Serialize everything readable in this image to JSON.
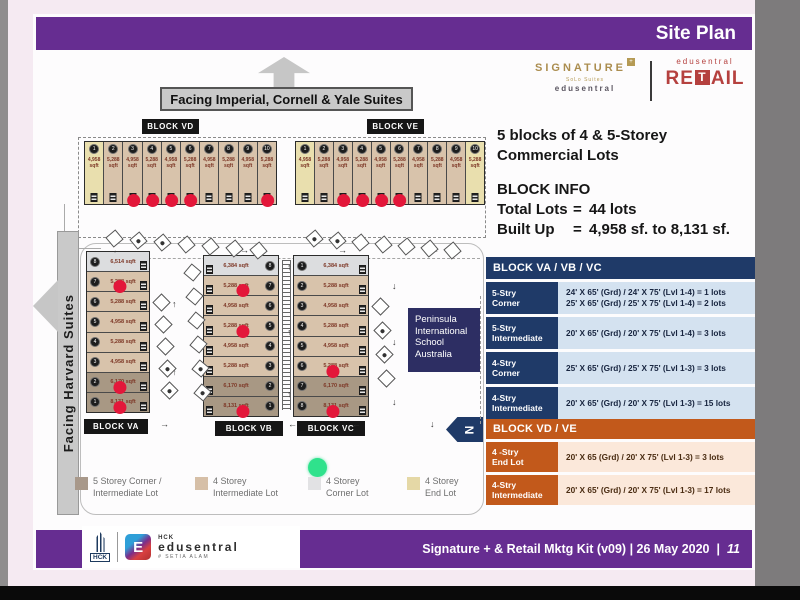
{
  "colors": {
    "purple": "#662d91",
    "photo_bg": "#f5eaf2",
    "slide_bg": "#fdfcfd",
    "navy": "#1f3a68",
    "navy_row_bg": "#d4e2f0",
    "orange": "#c2591b",
    "orange_row_bg": "#fbe8da",
    "school_navy": "#2d2e63",
    "red_dot": "#e3173a",
    "green_dot": "#2fe28c",
    "banner_gray": "#c9c9c9",
    "signature_gold": "#ab8d4f",
    "retail_red": "#b5413f",
    "lot_types": {
      "end": "#e9dfae",
      "int": "#d8c3ab",
      "corner": "#dcdddf",
      "five": "#a89884"
    }
  },
  "header": {
    "title": "Site Plan"
  },
  "logos": {
    "signature": {
      "name": "SIGNATURE",
      "plus": "+",
      "sub1": "SoLo Suites",
      "sub2": "edusentral"
    },
    "retail": {
      "top": "edusentral",
      "pre": "RE",
      "t": "T",
      "post": "AIL"
    }
  },
  "info": {
    "line1": "5 blocks of 4 & 5-Storey",
    "line2": "Commercial Lots",
    "block_info": "BLOCK INFO",
    "rows": [
      {
        "k": "Total Lots",
        "eq": "=",
        "v": "44 lots"
      },
      {
        "k": "Built Up",
        "eq": "=",
        "v": "4,958 sf. to 8,131 sf."
      }
    ]
  },
  "table_vavbvc": {
    "title": "BLOCK VA / VB / VC",
    "rows": [
      {
        "label": "5-Stry\nCorner",
        "value": "24' X 65' (Grd) / 24' X 75' (Lvl 1-4) = 1 lots\n25' X 65' (Grd) / 25' X 75' (Lvl 1-4) = 2 lots"
      },
      {
        "label": "5-Stry\nIntermediate",
        "value": "20' X 65' (Grd) / 20' X 75' (Lvl 1-4) = 3 lots"
      },
      {
        "label": "4-Stry\nCorner",
        "value": "25' X 65' (Grd) / 25' X 75' (Lvl 1-3) = 3 lots"
      },
      {
        "label": "4-Stry\nIntermediate",
        "value": "20' X 65' (Grd) / 20' X 75' (Lvl 1-3) = 15 lots"
      }
    ]
  },
  "table_vdve": {
    "title": "BLOCK VD / VE",
    "rows": [
      {
        "label": "4 -Stry\nEnd Lot",
        "value": "20' X 65 (Grd) / 20' X 75' (Lvl 1-3) = 3 lots"
      },
      {
        "label": "4-Stry\nIntermediate",
        "value": "20' X 65' (Grd) / 20' X 75' (Lvl 1-3) = 17 lots"
      }
    ]
  },
  "compass": {
    "letter": "N"
  },
  "school": {
    "text": "Peninsula\nInternational\nSchool\nAustralia"
  },
  "site": {
    "facing_top": "Facing Imperial, Cornell & Yale Suites",
    "facing_left": "Facing Harvard Suites",
    "sqft_suffix": "sqft",
    "blocks_h": [
      {
        "label": "BLOCK VD",
        "units": [
          {
            "n": "1",
            "a": "4,958",
            "t": "end",
            "d": false
          },
          {
            "n": "2",
            "a": "5,288",
            "t": "int",
            "d": false
          },
          {
            "n": "3",
            "a": "4,958",
            "t": "int",
            "d": true
          },
          {
            "n": "4",
            "a": "5,288",
            "t": "int",
            "d": true
          },
          {
            "n": "5",
            "a": "4,958",
            "t": "int",
            "d": true
          },
          {
            "n": "6",
            "a": "5,288",
            "t": "int",
            "d": true
          },
          {
            "n": "7",
            "a": "4,958",
            "t": "int",
            "d": false
          },
          {
            "n": "8",
            "a": "5,288",
            "t": "int",
            "d": false
          },
          {
            "n": "9",
            "a": "4,958",
            "t": "int",
            "d": false
          },
          {
            "n": "10",
            "a": "5,288",
            "t": "int",
            "d": true
          }
        ]
      },
      {
        "label": "BLOCK VE",
        "units": [
          {
            "n": "1",
            "a": "4,958",
            "t": "end",
            "d": false
          },
          {
            "n": "2",
            "a": "5,288",
            "t": "int",
            "d": false
          },
          {
            "n": "3",
            "a": "4,958",
            "t": "int",
            "d": true
          },
          {
            "n": "4",
            "a": "5,288",
            "t": "int",
            "d": true
          },
          {
            "n": "5",
            "a": "4,958",
            "t": "int",
            "d": true
          },
          {
            "n": "6",
            "a": "5,288",
            "t": "int",
            "d": true
          },
          {
            "n": "7",
            "a": "4,958",
            "t": "int",
            "d": false
          },
          {
            "n": "8",
            "a": "5,288",
            "t": "int",
            "d": false
          },
          {
            "n": "9",
            "a": "4,958",
            "t": "int",
            "d": false
          },
          {
            "n": "10",
            "a": "5,288",
            "t": "end",
            "d": false
          }
        ]
      }
    ],
    "blocks_v": [
      {
        "label": "BLOCK VA",
        "circle_side": "left",
        "units": [
          {
            "n": "8",
            "a": "6,514 sqft",
            "t": "corner",
            "d": false
          },
          {
            "n": "7",
            "a": "5,288 sqft",
            "t": "int",
            "d": true
          },
          {
            "n": "6",
            "a": "5,288 sqft",
            "t": "int",
            "d": false
          },
          {
            "n": "5",
            "a": "4,958 sqft",
            "t": "int",
            "d": false
          },
          {
            "n": "4",
            "a": "5,288 sqft",
            "t": "int",
            "d": false
          },
          {
            "n": "3",
            "a": "4,958 sqft",
            "t": "int",
            "d": false
          },
          {
            "n": "2",
            "a": "6,170 sqft",
            "t": "five",
            "d": true
          },
          {
            "n": "1",
            "a": "8,131 sqft",
            "t": "five",
            "d": true
          }
        ]
      },
      {
        "label": "BLOCK VB",
        "circle_side": "right",
        "units": [
          {
            "n": "8",
            "a": "6,384 sqft",
            "t": "corner",
            "d": false
          },
          {
            "n": "7",
            "a": "5,288 sqft",
            "t": "int",
            "d": true
          },
          {
            "n": "6",
            "a": "4,958 sqft",
            "t": "int",
            "d": false
          },
          {
            "n": "5",
            "a": "5,288 sqft",
            "t": "int",
            "d": true
          },
          {
            "n": "4",
            "a": "4,958 sqft",
            "t": "int",
            "d": false
          },
          {
            "n": "3",
            "a": "5,288 sqft",
            "t": "int",
            "d": false
          },
          {
            "n": "2",
            "a": "6,170 sqft",
            "t": "five",
            "d": false
          },
          {
            "n": "1",
            "a": "8,131 sqft",
            "t": "five",
            "d": true
          }
        ]
      },
      {
        "label": "BLOCK VC",
        "circle_side": "left",
        "units": [
          {
            "n": "1",
            "a": "6,384 sqft",
            "t": "corner",
            "d": false
          },
          {
            "n": "2",
            "a": "5,288 sqft",
            "t": "int",
            "d": false
          },
          {
            "n": "3",
            "a": "4,958 sqft",
            "t": "int",
            "d": false
          },
          {
            "n": "4",
            "a": "5,288 sqft",
            "t": "int",
            "d": false
          },
          {
            "n": "5",
            "a": "4,958 sqft",
            "t": "int",
            "d": false
          },
          {
            "n": "6",
            "a": "5,288 sqft",
            "t": "int",
            "d": true
          },
          {
            "n": "7",
            "a": "6,170 sqft",
            "t": "five",
            "d": false
          },
          {
            "n": "8",
            "a": "8,131 sqft",
            "t": "five",
            "d": true
          }
        ]
      }
    ],
    "legend": [
      {
        "color": "#a8988a",
        "label": "5 Storey Corner /\nIntermediate Lot"
      },
      {
        "color": "#d6bfa7",
        "label": "4 Storey\nIntermediate Lot"
      },
      {
        "color": "#e2e2e4",
        "label": "4 Storey\nCorner Lot"
      },
      {
        "color": "#e5d8a6",
        "label": "4 Storey\nEnd Lot"
      }
    ],
    "road_arrows": [
      {
        "g": "←",
        "x": 112,
        "y": 246
      },
      {
        "g": "→",
        "x": 240,
        "y": 246
      },
      {
        "g": "→",
        "x": 338,
        "y": 246
      },
      {
        "g": "←",
        "x": 430,
        "y": 246
      },
      {
        "g": "↑",
        "x": 287,
        "y": 263
      },
      {
        "g": "↑",
        "x": 287,
        "y": 328
      },
      {
        "g": "↑",
        "x": 287,
        "y": 390
      },
      {
        "g": "↓",
        "x": 392,
        "y": 282
      },
      {
        "g": "↓",
        "x": 392,
        "y": 338
      },
      {
        "g": "↓",
        "x": 392,
        "y": 398
      },
      {
        "g": "↑",
        "x": 172,
        "y": 300
      },
      {
        "g": "↑",
        "x": 172,
        "y": 368
      },
      {
        "g": "→",
        "x": 160,
        "y": 420
      },
      {
        "g": "←",
        "x": 288,
        "y": 420
      },
      {
        "g": "←",
        "x": 352,
        "y": 420
      },
      {
        "g": "↓",
        "x": 430,
        "y": 420
      }
    ]
  },
  "footer": {
    "hck": "HCK",
    "edu_icon_letter": "E",
    "edu_top": "HCK",
    "edu_name": "edusentral",
    "edu_sub": "# SETIA ALAM",
    "text": "Signature + & Retail Mktg Kit (v09) | 26 May 2020",
    "sep": "|",
    "page": "11"
  }
}
